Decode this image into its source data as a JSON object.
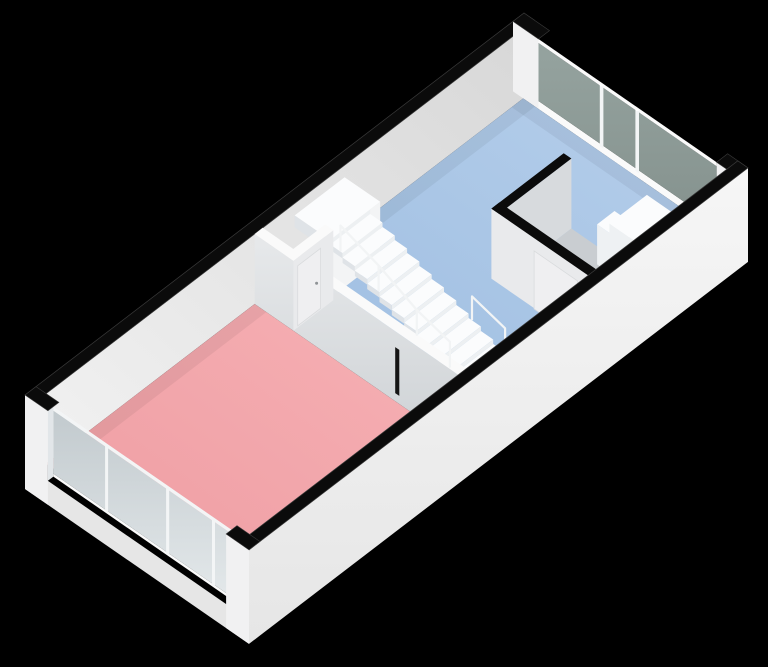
{
  "scene": {
    "kind": "3d-floorplan-isometric-view",
    "background": "#000000"
  },
  "rooms": [
    {
      "id": "red-room",
      "floor_color_name": "red",
      "windows": "full-height glass wall with 3 mullions"
    },
    {
      "id": "blue-room",
      "floor_color_name": "blue",
      "windows": "window wall with 2 mullions"
    },
    {
      "id": "small-room",
      "floor_color_name": "gray",
      "note": "enclosed room with door"
    }
  ],
  "features": {
    "staircase": {
      "steps": 12,
      "landing": true,
      "railing_posts_left": 4,
      "railing_posts_right": 2
    },
    "doors": [
      "front-door",
      "small-room-door"
    ],
    "kitchen_counter": {
      "top": "black",
      "sink": true
    },
    "appliances": 2
  },
  "colors": {
    "background": "#000000",
    "wall_cut": "#0b0b0b",
    "cap_rim": "#3a3a3a",
    "wall_exterior_hi": "#f6f6f6",
    "wall_exterior_lo": "#e6e6e6",
    "wall_interior_hi": "#f2f2f2",
    "wall_interior_lo": "#d7d7d7",
    "pier_white": "#f1f1f2",
    "sill_white": "#fafafa",
    "floor_red_hi": "#f6b1b5",
    "floor_red_lo": "#ee9ba1",
    "floor_blue_hi": "#b6cfeb",
    "floor_blue_lo": "#9cbce0",
    "glass_ne_hi": "#95a39f",
    "glass_ne_lo": "#85928e",
    "glass_sw_hi": "#c2cace",
    "glass_sw_lo": "#e3e8ea",
    "mullion": "#f3f5f6",
    "stair_tread": "#fbfcfd",
    "stair_riser": "#edf0f2",
    "stair_side": "#dfe3e7",
    "stair_under": "#f3f4f5",
    "rail": "#f2f4f5",
    "partition_hi": "#e7e9eb",
    "partition_lo": "#ced2d5",
    "partition_top": "#fafafa",
    "wc_inner_face": "#d7dadd",
    "wc_inner_floor": "#c9cdd1",
    "wc_west_face": "#e9eaec",
    "door_leaf": "#efeff1",
    "door_handle": "#8f9396",
    "appliance_top": "#fbfcfd",
    "appliance_sw": "#eef1f3",
    "appliance_se": "#e2e6e9",
    "counter_top": "#111111",
    "counter_front": "#1c1c1c",
    "counter_side": "#272727",
    "sink": "#f4f4f4",
    "floor_shadow": "rgba(0,0,0,0.055)"
  }
}
